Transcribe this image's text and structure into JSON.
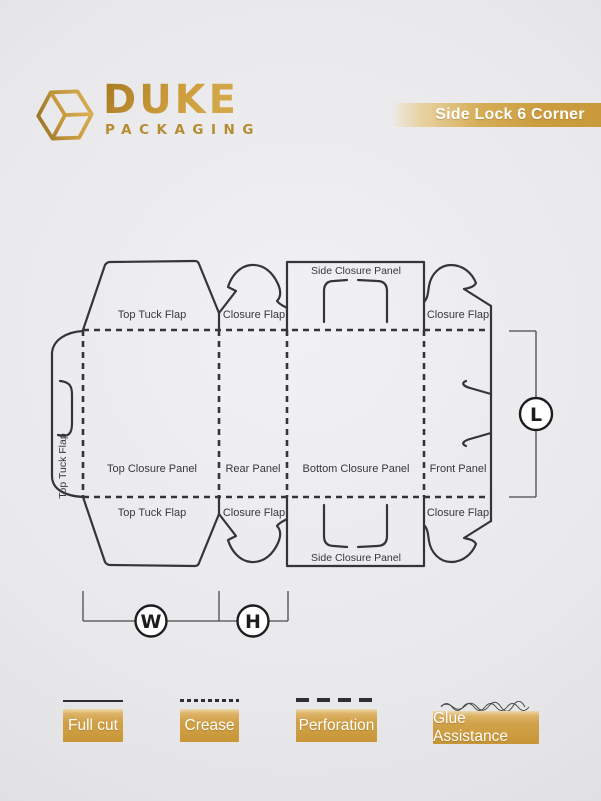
{
  "brand": {
    "name": "DUKE",
    "subtitle": "PACKAGING",
    "icon": "cube-box-icon",
    "gold_color": "#c99a3c"
  },
  "banner": {
    "title": "Side Lock 6 Corner",
    "bg_color": "#cc9d3f",
    "text_color": "#ffffff"
  },
  "diagram": {
    "line_color": "#353537",
    "labels": {
      "top_tuck_flap_top": "Top Tuck Flap",
      "closure_flap_rear_top": "Closure Flap",
      "side_closure_panel_top": "Side Closure Panel",
      "closure_flap_front_top": "Closure Flap",
      "top_tuck_flap_left": "Top Tuck Flap",
      "top_closure_panel": "Top Closure Panel",
      "rear_panel": "Rear Panel",
      "bottom_closure_panel": "Bottom Closure Panel",
      "front_panel": "Front Panel",
      "top_tuck_flap_bottom": "Top Tuck Flap",
      "closure_flap_rear_bottom": "Closure Flap",
      "closure_flap_front_bottom": "Closure Flap",
      "side_closure_panel_bottom": "Side Closure Panel"
    },
    "dimensions": {
      "length_label": "L",
      "width_label": "W",
      "height_label": "H"
    }
  },
  "legend": {
    "items": [
      {
        "label": "Full cut",
        "line_style": "solid"
      },
      {
        "label": "Crease",
        "line_style": "dotted"
      },
      {
        "label": "Perforation",
        "line_style": "dashed"
      },
      {
        "label": "Glue Assistance",
        "line_style": "wavy"
      }
    ],
    "button_color": "#cd9c40"
  }
}
